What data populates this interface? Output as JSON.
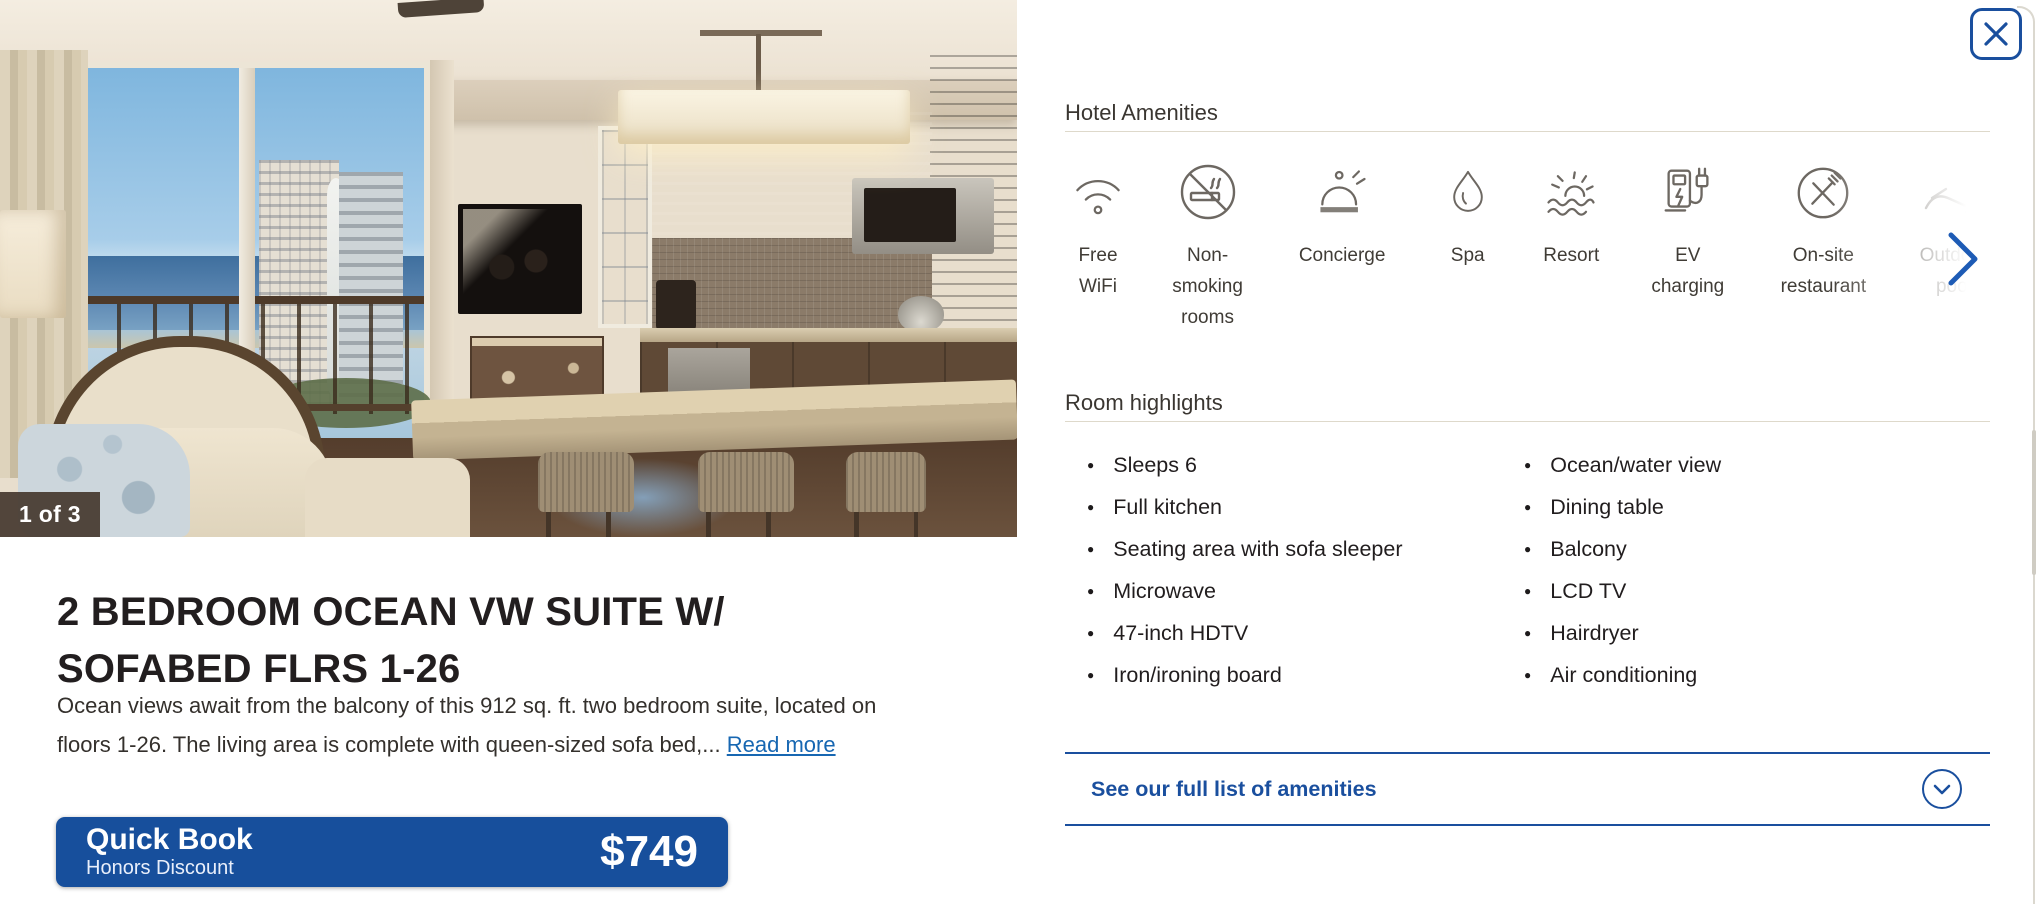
{
  "colors": {
    "brand_blue": "#1a4f9e",
    "button_blue": "#174f9c",
    "link_blue": "#1767b2",
    "icon_gray": "#6d6862",
    "divider": "#ded9cb"
  },
  "gallery": {
    "counter": "1 of 3"
  },
  "listing": {
    "title": "2 BEDROOM OCEAN VW SUITE W/ SOFABED FLRS 1-26",
    "description_line1": "Ocean views await from the balcony of this 912 sq. ft. two bedroom suite, located on",
    "description_line2": "floors 1-26. The living area is complete with queen-sized sofa bed,...",
    "read_more": "Read more"
  },
  "quick_book": {
    "label": "Quick Book",
    "sublabel": "Honors Discount",
    "price": "$749"
  },
  "amenities": {
    "title": "Hotel Amenities",
    "items": [
      {
        "icon": "wifi-icon",
        "label": "Free WiFi"
      },
      {
        "icon": "no-smoking-icon",
        "label": "Non-smoking rooms"
      },
      {
        "icon": "concierge-bell-icon",
        "label": "Concierge"
      },
      {
        "icon": "spa-droplet-icon",
        "label": "Spa"
      },
      {
        "icon": "resort-sun-icon",
        "label": "Resort"
      },
      {
        "icon": "ev-charging-icon",
        "label": "EV charging"
      },
      {
        "icon": "restaurant-icon",
        "label": "On-site restaurant"
      },
      {
        "icon": "outdoor-pool-icon",
        "label": "Outdoor pool"
      }
    ]
  },
  "highlights": {
    "title": "Room highlights",
    "left": [
      "Sleeps 6",
      "Full kitchen",
      "Seating area with sofa sleeper",
      "Microwave",
      "47-inch HDTV",
      "Iron/ironing board"
    ],
    "right": [
      "Ocean/water view",
      "Dining table",
      "Balcony",
      "LCD TV",
      "Hairdryer",
      "Air conditioning"
    ]
  },
  "amenities_footer": {
    "link": "See our full list of amenities"
  }
}
